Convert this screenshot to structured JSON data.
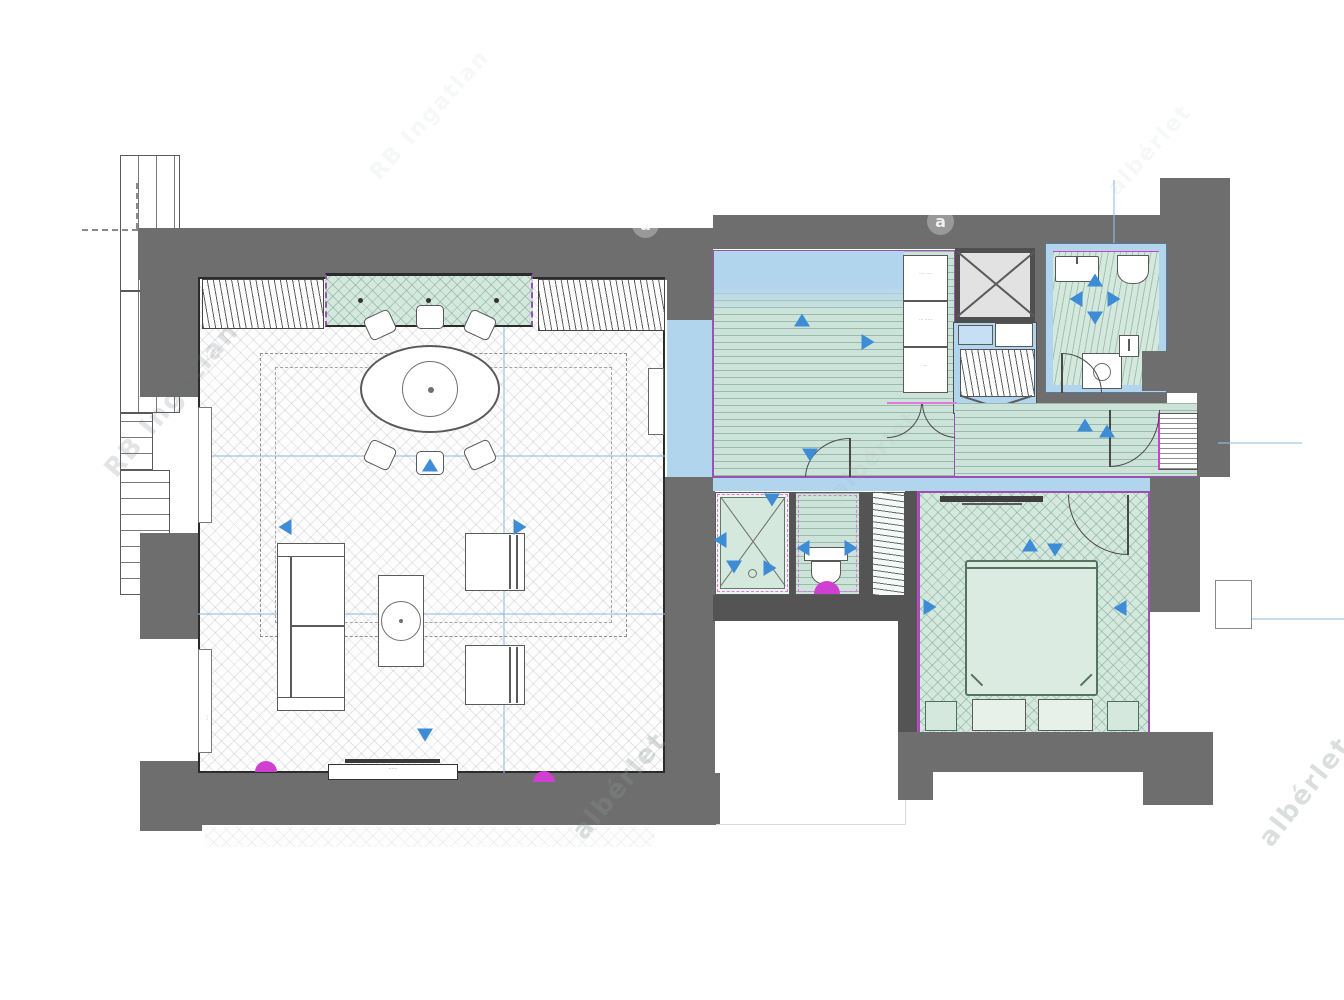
{
  "document": {
    "type": "floor-plan",
    "description": "apartment floor plan with living room, hall-kitchen, bathroom, shower room, wc, wardrobe and bedroom"
  },
  "colors": {
    "wall": "#6e6e6e",
    "wallDark": "#545454",
    "teal": "#cde3d9",
    "tealHerr": "#d5e8de",
    "lblue": "#b2d5ee",
    "lblue2": "#c6dff4",
    "arrow": "#3f8cd6",
    "magenta": "#cf3fd0",
    "purple": "#9d50b4",
    "pinkDash": "#df79dd",
    "bedFill": "#dcebe2",
    "bedEdge": "#54745f",
    "shaft": "#e2e2e2"
  },
  "rooms": [
    {
      "id": "living-room"
    },
    {
      "id": "hall-kitchen"
    },
    {
      "id": "entry-strip"
    },
    {
      "id": "corridor"
    },
    {
      "id": "bathroom"
    },
    {
      "id": "small-hall"
    },
    {
      "id": "shower-room"
    },
    {
      "id": "wc"
    },
    {
      "id": "wardrobe"
    },
    {
      "id": "bedroom"
    }
  ],
  "labels": {
    "cabinets": [
      "···· ····",
      "··· ·····",
      "···"
    ],
    "tv_console": "······",
    "wall_note_top": "····",
    "wall_note_bottom": "····"
  },
  "watermarks": [
    {
      "text": "RB Ingatlan",
      "x": 172,
      "y": 400,
      "angle": -50,
      "size": 26,
      "opacity": 0.18,
      "color": "rgba(100,110,115,1)"
    },
    {
      "text": "RB Ingatlan",
      "x": 430,
      "y": 115,
      "angle": -48,
      "size": 22,
      "opacity": 0.06,
      "color": "rgba(120,130,132,1)"
    },
    {
      "text": "albérlet",
      "x": 1150,
      "y": 150,
      "angle": -48,
      "size": 22,
      "opacity": 0.06,
      "color": "rgba(120,130,132,1)"
    },
    {
      "text": "albérlet",
      "x": 620,
      "y": 786,
      "angle": -50,
      "size": 26,
      "opacity": 0.3,
      "color": "rgba(135,148,144,1)"
    },
    {
      "text": "albérlet",
      "x": 1305,
      "y": 792,
      "angle": -52,
      "size": 26,
      "opacity": 0.3,
      "color": "rgba(135,148,144,1)"
    },
    {
      "text": "albérlet",
      "x": 875,
      "y": 455,
      "angle": -45,
      "size": 22,
      "opacity": 0.1,
      "color": "rgba(160,172,170,1)"
    }
  ],
  "logos": [
    {
      "glyph": "a",
      "x": 645,
      "y": 224
    },
    {
      "glyph": "a",
      "x": 940,
      "y": 221
    }
  ],
  "arrows": [
    {
      "x": 310,
      "y": 310,
      "dir": "up"
    },
    {
      "x": 165,
      "y": 372,
      "dir": "left"
    },
    {
      "x": 400,
      "y": 372,
      "dir": "right"
    },
    {
      "x": 305,
      "y": 580,
      "dir": "down"
    },
    {
      "x": 682,
      "y": 165,
      "dir": "up"
    },
    {
      "x": 748,
      "y": 187,
      "dir": "right"
    },
    {
      "x": 690,
      "y": 300,
      "dir": "down"
    },
    {
      "x": 965,
      "y": 270,
      "dir": "up"
    },
    {
      "x": 975,
      "y": 125,
      "dir": "up"
    },
    {
      "x": 975,
      "y": 163,
      "dir": "down"
    },
    {
      "x": 956,
      "y": 144,
      "dir": "left"
    },
    {
      "x": 994,
      "y": 144,
      "dir": "right"
    },
    {
      "x": 652,
      "y": 345,
      "dir": "down"
    },
    {
      "x": 600,
      "y": 385,
      "dir": "left"
    },
    {
      "x": 614,
      "y": 412,
      "dir": "down"
    },
    {
      "x": 650,
      "y": 413,
      "dir": "right"
    },
    {
      "x": 683,
      "y": 393,
      "dir": "left"
    },
    {
      "x": 731,
      "y": 393,
      "dir": "right"
    },
    {
      "x": 910,
      "y": 390,
      "dir": "up"
    },
    {
      "x": 935,
      "y": 395,
      "dir": "down"
    },
    {
      "x": 810,
      "y": 452,
      "dir": "right"
    },
    {
      "x": 1000,
      "y": 453,
      "dir": "left"
    },
    {
      "x": 987,
      "y": 276,
      "dir": "up"
    }
  ]
}
